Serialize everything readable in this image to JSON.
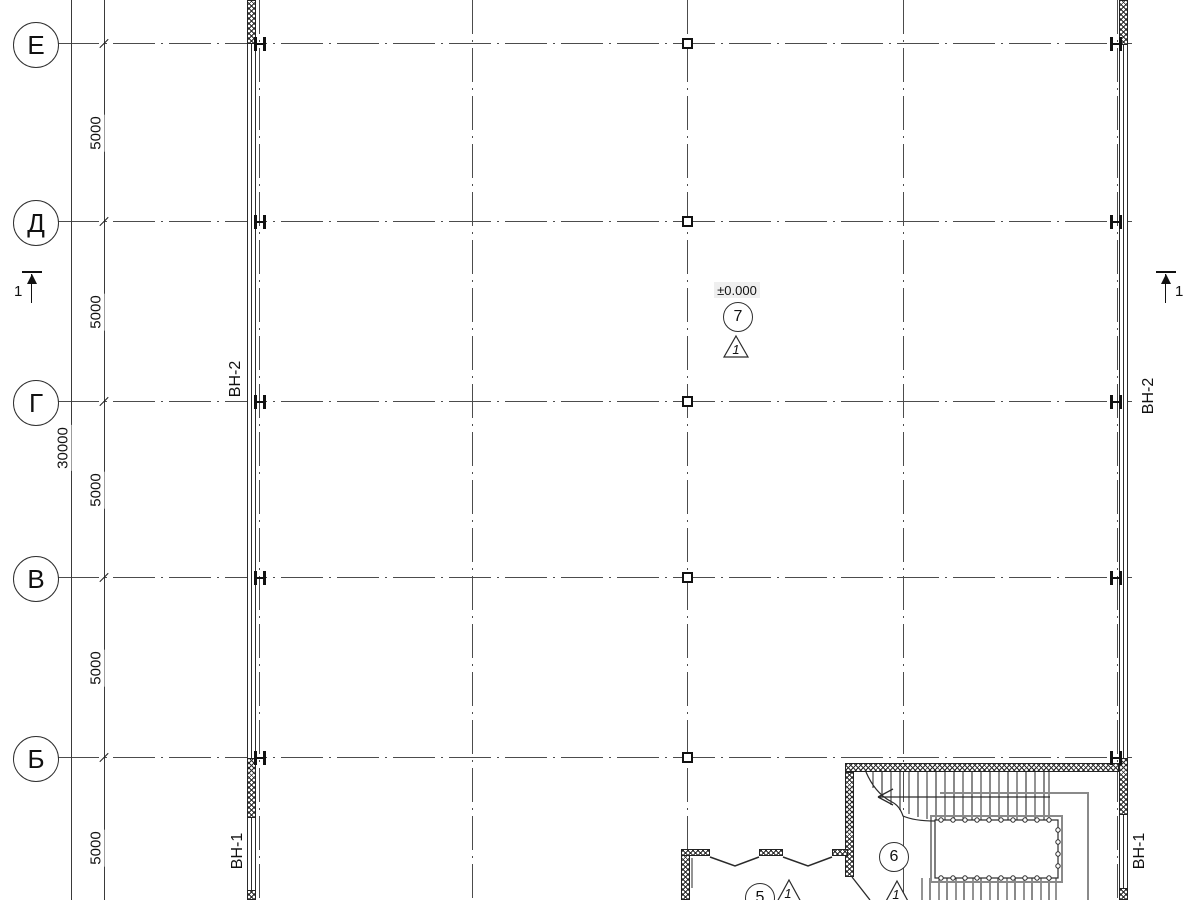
{
  "axes": {
    "rows": [
      {
        "label": "Е"
      },
      {
        "label": "Д"
      },
      {
        "label": "Г"
      },
      {
        "label": "В"
      },
      {
        "label": "Б"
      }
    ]
  },
  "dimensions": {
    "spans": [
      "5000",
      "5000",
      "5000",
      "5000",
      "5000"
    ],
    "total": "30000"
  },
  "wall_tags": {
    "left_mid": "ВН-2",
    "left_bottom": "ВН-1",
    "right_mid": "ВН-2",
    "right_bottom": "ВН-1"
  },
  "section_marks": {
    "left": "1",
    "right": "1"
  },
  "elevation": {
    "value": "±0.000"
  },
  "room_tags": [
    {
      "number": "7",
      "detail": "1"
    },
    {
      "number": "6",
      "detail": "1"
    },
    {
      "number": "5",
      "detail": "1"
    }
  ],
  "colors": {
    "line": "#4c4c4c",
    "wall": "#222222",
    "handrail_gray": "#8a8a8a",
    "elevation_bg": "#efefef"
  }
}
